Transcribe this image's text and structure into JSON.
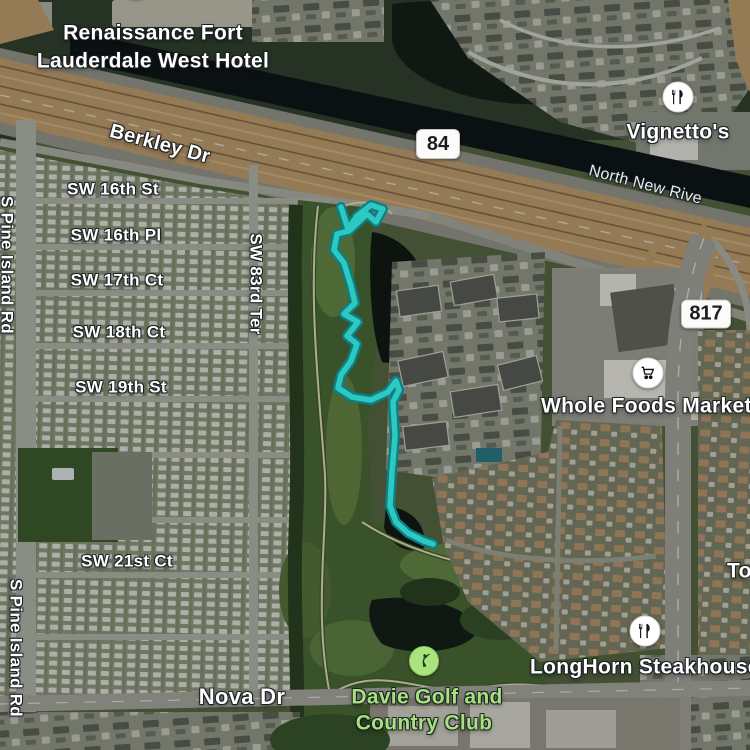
{
  "map": {
    "labels": {
      "hotel_line1": "Renaissance Fort",
      "hotel_line2": "Lauderdale West Hotel",
      "berkley": "Berkley Dr",
      "shield_84": "84",
      "vignettos": "Vignetto's",
      "river": "North New Rive",
      "shield_817": "817",
      "whole_foods": "Whole Foods Market",
      "sw16st": "SW 16th St",
      "sw16pl": "SW 16th Pl",
      "sw17ct": "SW 17th Ct",
      "sw18ct": "SW 18th Ct",
      "sw19st": "SW 19th St",
      "sw21ct": "SW 21st Ct",
      "sw83ter": "SW 83rd Ter",
      "pine_island_top": "S Pine Island Rd",
      "pine_island_bottom": "S Pine Island Rd",
      "nova": "Nova Dr",
      "longhorn": "LongHorn Steakhouse",
      "partial_to": "To",
      "golf_line1": "Davie Golf and",
      "golf_line2": "Country Club"
    },
    "icons": {
      "hotel": "lodging-icon",
      "vignettos": "restaurant-icon",
      "whole_foods": "grocery-cart-icon",
      "longhorn": "restaurant-icon",
      "golf": "golfer-icon"
    },
    "colors": {
      "route_core": "#2dc9c0",
      "route_casing": "#0c7f85",
      "golf_label_green": "#a6e17d",
      "highway_pavement": "#c9a474",
      "canal_water": "#10181a"
    },
    "route": {
      "points": "341,207 348,229 357,216 371,205 383,209 376,222 367,214 349,231 337,234 334,250 344,263 351,286 355,303 344,314 358,322 347,336 357,344 351,361 341,375 338,388 352,397 371,400 388,392 396,381 399,390 393,402 395,436 392,472 390,506 396,522 408,533 424,541 433,544"
    }
  }
}
